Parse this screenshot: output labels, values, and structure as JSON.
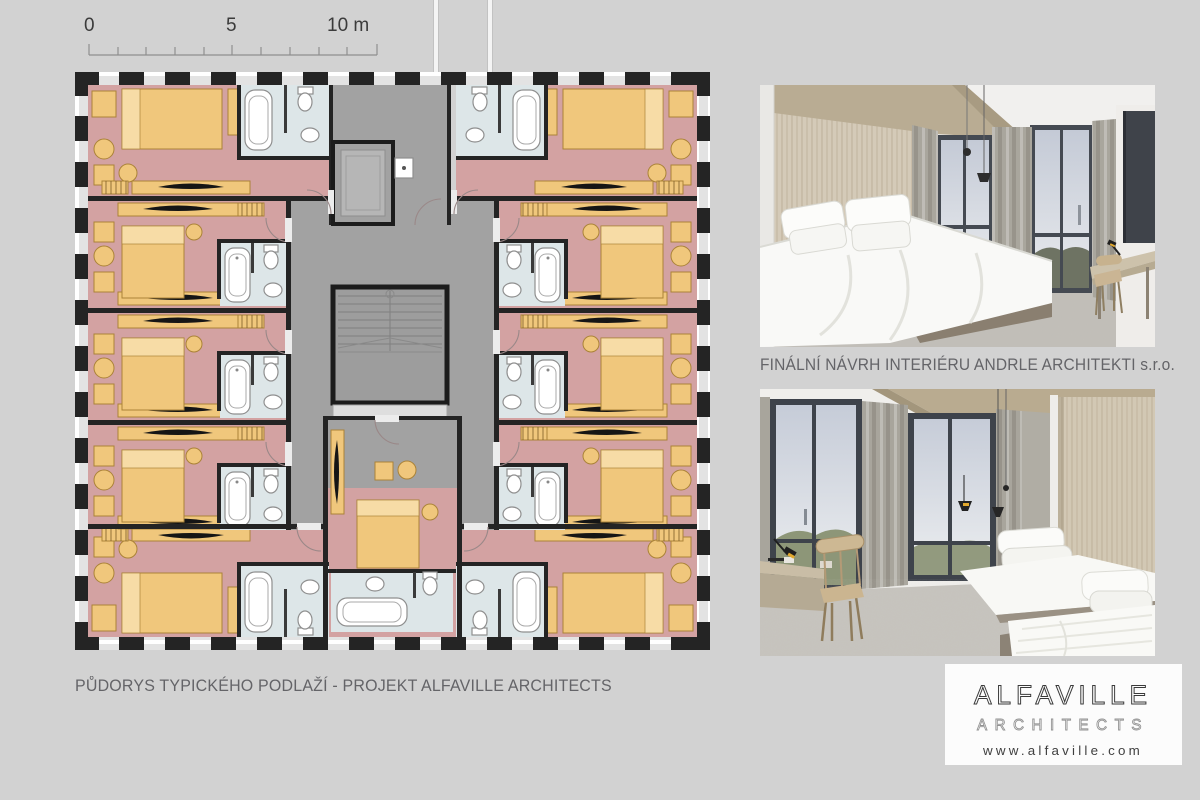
{
  "theme": {
    "bg": "#d2d2d2",
    "wall": "#242424",
    "pink": "#d3a2a2",
    "yellow": "#f0c77c",
    "yellowLight": "#f7dca6",
    "yellowStroke": "#ab8338",
    "bath": "#dde6e8",
    "core": "#a2a2a2",
    "coreLight": "#b8b8b8",
    "landing": "#dedede",
    "captionColor": "#646468",
    "scaleColor": "#3b3b3b",
    "logoInk": "#3a3a3a",
    "logoGray": "#929292",
    "photoWood": "#d2c8b4",
    "photoWoodCeiling": "#b9ab90",
    "photoWindowFrame": "#3e434b",
    "photoCurtain": "#a8a59c",
    "photoCarpet": "#c3c0ba",
    "photoBed": "#f9f9f6",
    "photoTrees": "#6e7363",
    "photoHills": "#8d9678",
    "lampYellow": "#e2a92e"
  },
  "scale_bar": {
    "labels": [
      "0",
      "5",
      "10 m"
    ]
  },
  "plan": {
    "caption": "PŮDORYS TYPICKÉHO PODLAŽÍ - PROJEKT ALFAVILLE ARCHITECTS"
  },
  "photos": {
    "caption": "FINÁLNÍ NÁVRH INTERIÉRU ANDRLE ARCHITEKTI s.r.o."
  },
  "logo": {
    "name": "ALFAVILLE",
    "subtitle": "ARCHITECTS",
    "website": "www.alfaville.com"
  }
}
